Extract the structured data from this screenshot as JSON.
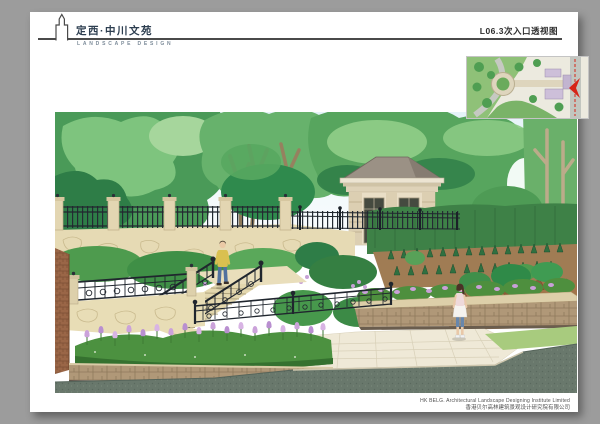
{
  "page": {
    "background": "#9c9c9c",
    "paper": "#ffffff"
  },
  "header": {
    "logo_icon": "tower-outline-icon",
    "title": "定西·中川文苑",
    "subtitle": "LANDSCAPE DESIGN",
    "sheet_label": "L06.3次入口透视图",
    "title_color": "#2d3e50",
    "rule_color": "#4a4a4a"
  },
  "keymap": {
    "type": "site-plan-inset",
    "viewpoint_marker": "red-arrow",
    "marker_color": "#d62418"
  },
  "illustration": {
    "description": "Perspective rendering of a secondary entrance: terraced flagstone stairs with ornamental iron railings, gate pavilion, clipped hedges, tulip planting beds, paved plaza and road",
    "figures": [
      "man-descending-stairs",
      "woman-standing-on-plaza"
    ],
    "palette": {
      "sky": "#eaf5fa",
      "foliage_light": "#8bca84",
      "foliage_mid": "#57a55e",
      "foliage_dark": "#2e7d47",
      "stone_wall": "#e6dab4",
      "masonry": "#b09878",
      "iron_fence": "#20262e",
      "pavement": "#efe9d7",
      "road": "#69786c",
      "flower_purple": "#c9a0d8",
      "pavilion_wall": "#e9dec6",
      "pavilion_roof": "#9b9185",
      "soil": "#a07c54",
      "lawn": "#a8cb7e",
      "brick": "#9a6647"
    }
  },
  "footer": {
    "company_en": "HK BELG. Architectural Landscape Designing Institute Limited",
    "company_cn": "香港贝尔高林建筑景观设计研究院有限公司",
    "text_color": "#4f4f4f"
  }
}
